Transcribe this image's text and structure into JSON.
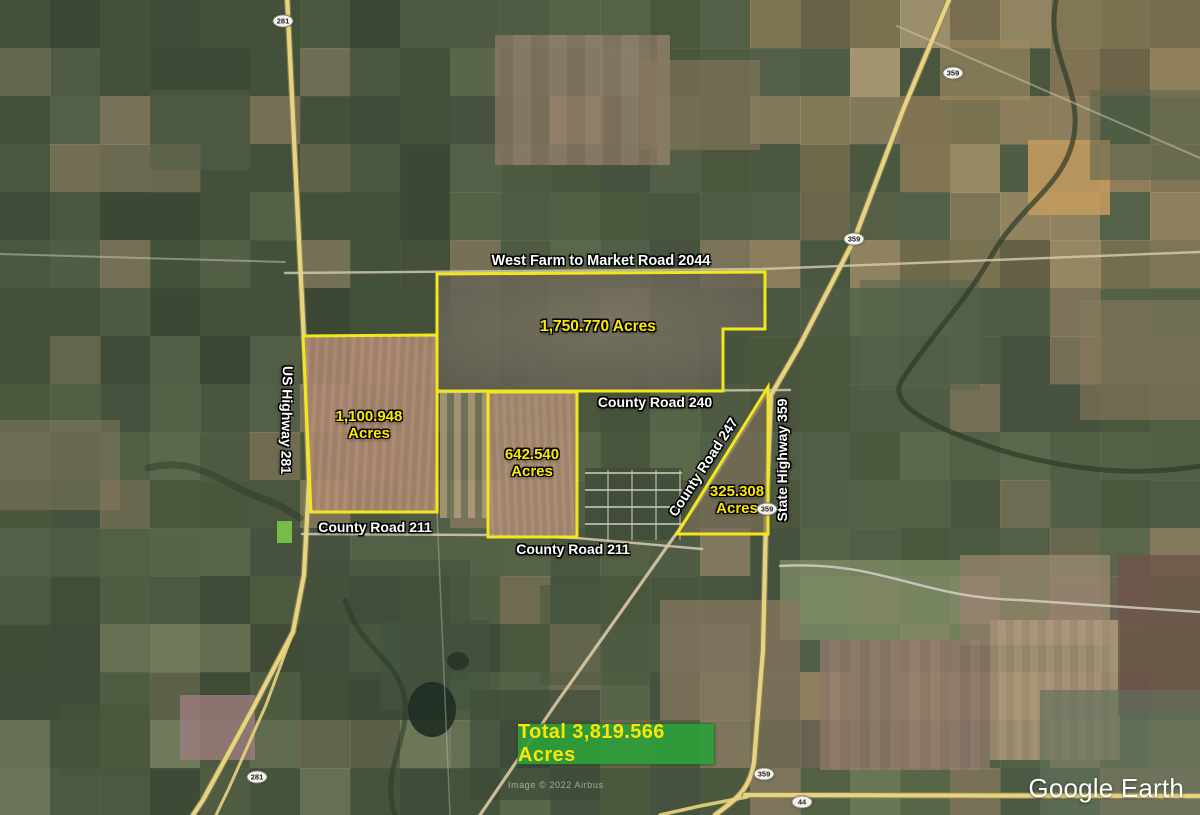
{
  "map": {
    "logo": "Google Earth",
    "attribution": "Image © 2022 Airbus",
    "total_box": {
      "label": "Total 3,819.566 Acres",
      "value": "3,819.566",
      "unit": "Acres"
    },
    "colors": {
      "parcel_boundary": "#F2E71C",
      "acre_label": "#FFE800",
      "road_label": "#FFFFFF",
      "total_bg": "#2CA038",
      "total_text": "#FFE600",
      "highway": "#E8D47E"
    },
    "parcels": [
      {
        "name": "north-parcel",
        "label": "1,750.770 Acres",
        "label_lines": [
          "1,750.770 Acres"
        ],
        "label_x": 598,
        "label_y": 327,
        "font_size": 15.5,
        "points": "437,274 765,272 765,329 723,329 723,391 437,391"
      },
      {
        "name": "west-parcel",
        "label": "1,100.948 Acres",
        "label_lines": [
          "1,100.948",
          "Acres"
        ],
        "label_x": 369,
        "label_y": 425,
        "font_size": 15,
        "points": "303,336 437,335 437,512 311,512"
      },
      {
        "name": "middle-parcel",
        "label": "642.540 Acres",
        "label_lines": [
          "642.540",
          "Acres"
        ],
        "label_x": 532,
        "label_y": 463,
        "font_size": 15,
        "points": "488,392 577,392 577,537 488,537"
      },
      {
        "name": "east-parcel",
        "label": "325.308 Acres",
        "label_lines": [
          "325.308",
          "Acres"
        ],
        "label_x": 737,
        "label_y": 500,
        "font_size": 15,
        "points": "768,387 768,534 677,534"
      }
    ],
    "road_labels": [
      {
        "name": "west-farm-to-market-road-2044",
        "text": "West Farm to Market Road 2044",
        "x": 601,
        "y": 261,
        "rot": 0,
        "size": 14.5
      },
      {
        "name": "county-road-240",
        "text": "County Road 240",
        "x": 655,
        "y": 402,
        "rot": 0,
        "size": 14
      },
      {
        "name": "county-road-211-west",
        "text": "County Road 211",
        "x": 375,
        "y": 527,
        "rot": 0,
        "size": 14
      },
      {
        "name": "county-road-211-south",
        "text": "County Road 211",
        "x": 573,
        "y": 549,
        "rot": 0,
        "size": 14
      },
      {
        "name": "county-road-247",
        "text": "County Road 247",
        "x": 703,
        "y": 467,
        "rot": -57,
        "size": 14
      },
      {
        "name": "us-highway-281",
        "text": "US Highway 281",
        "x": 287,
        "y": 420,
        "rot": 91,
        "size": 14
      },
      {
        "name": "state-highway-359",
        "text": "State Highway 359",
        "x": 782,
        "y": 460,
        "rot": -90,
        "size": 14
      }
    ],
    "route_shields": [
      {
        "num": "281",
        "x": 283,
        "y": 21
      },
      {
        "num": "281",
        "x": 257,
        "y": 777
      },
      {
        "num": "359",
        "x": 953,
        "y": 73
      },
      {
        "num": "359",
        "x": 854,
        "y": 239
      },
      {
        "num": "359",
        "x": 767,
        "y": 509
      },
      {
        "num": "359",
        "x": 764,
        "y": 774
      },
      {
        "num": "44",
        "x": 802,
        "y": 802
      }
    ]
  }
}
